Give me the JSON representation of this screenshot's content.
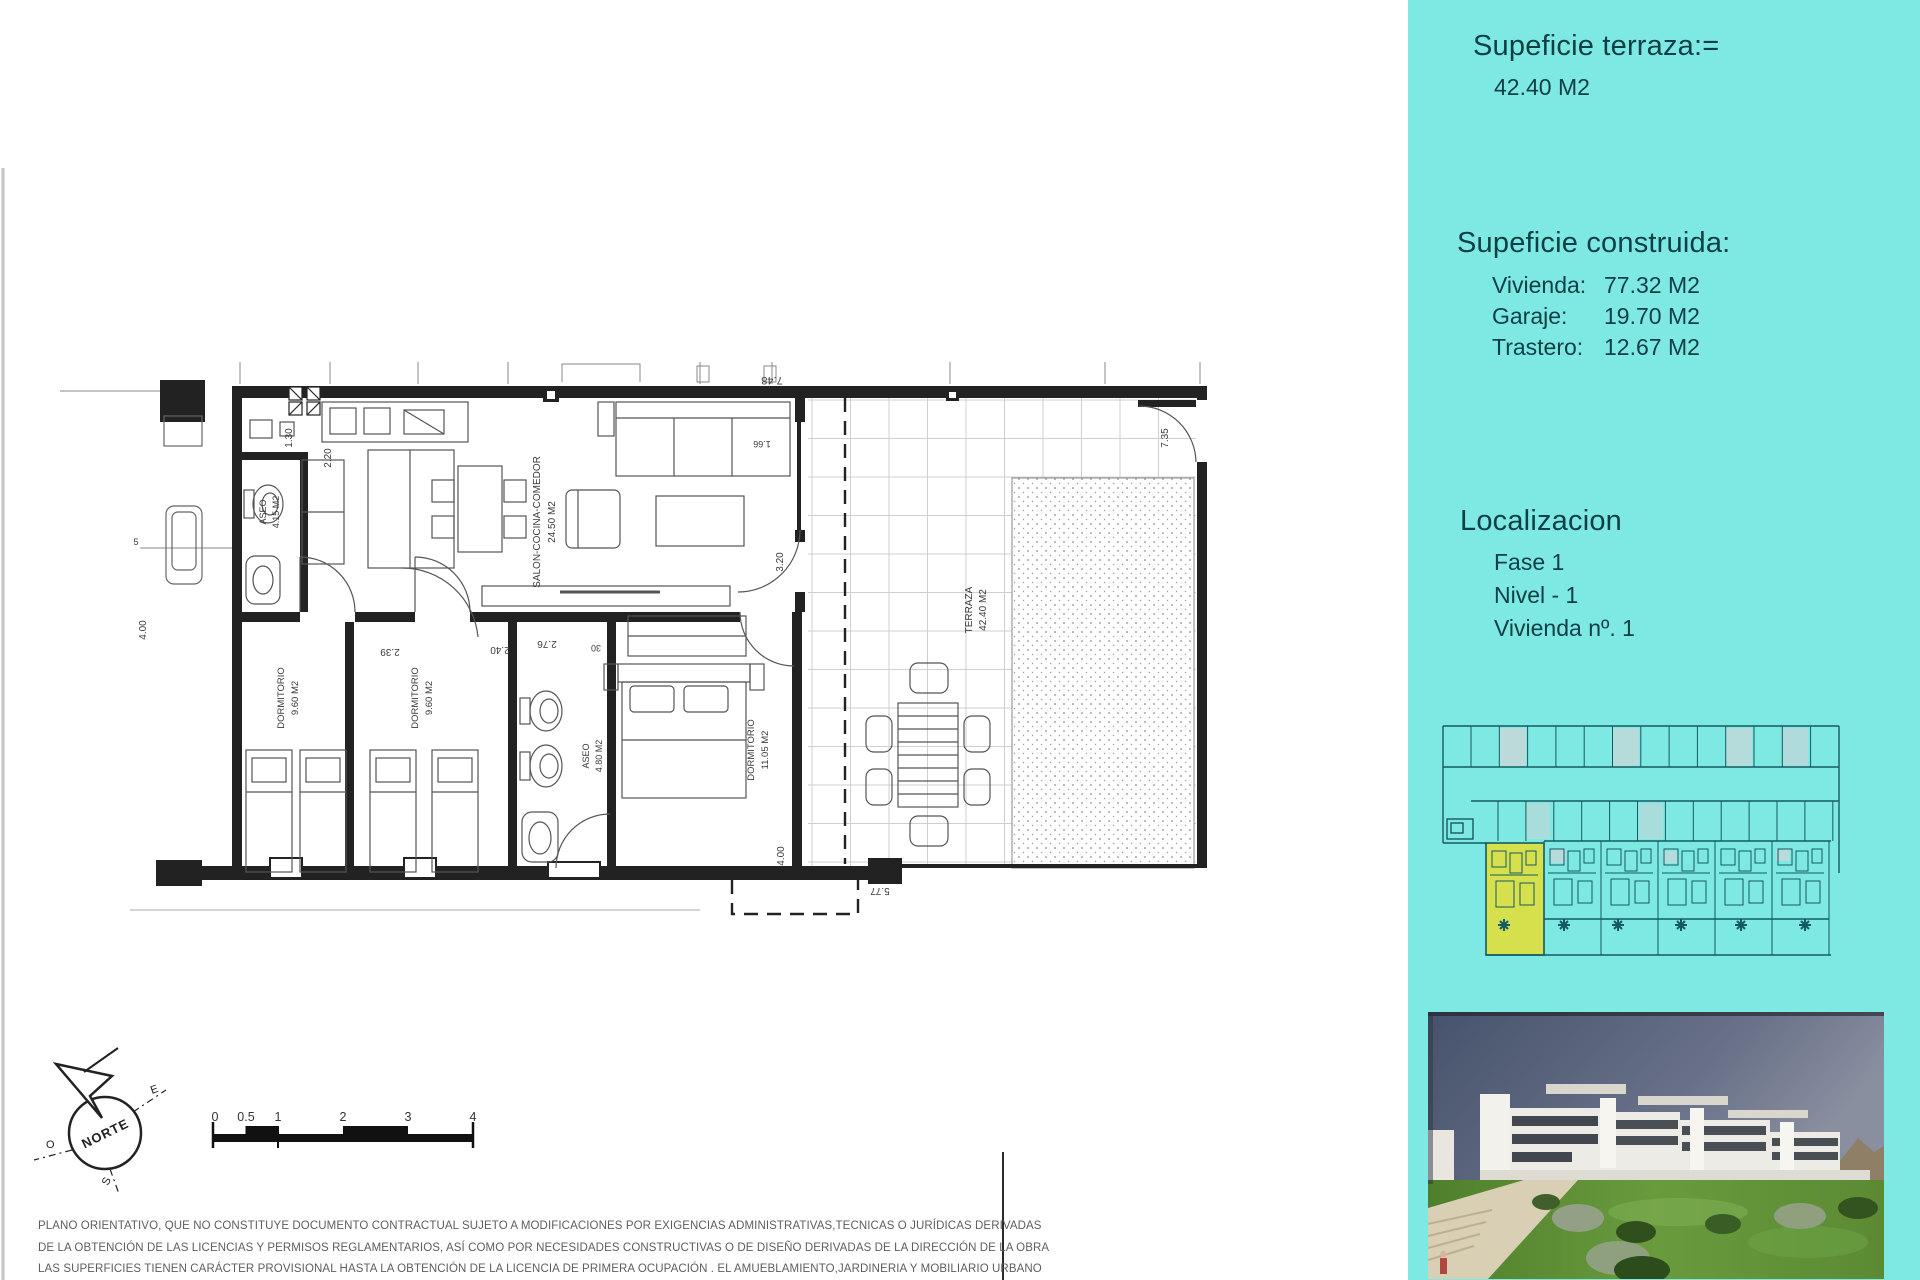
{
  "panel": {
    "terrace_heading": "Supeficie terraza:=",
    "terrace_value": "42.40 M2",
    "built_heading": "Supeficie construida:",
    "built_items": [
      {
        "label": "Vivienda:",
        "value": "77.32 M2"
      },
      {
        "label": "Garaje:",
        "value": "19.70 M2"
      },
      {
        "label": "Trastero:",
        "value": "12.67 M2"
      }
    ],
    "location_heading": "Localizacion",
    "location_items": [
      "Fase 1",
      "Nivel - 1",
      "Vivienda nº. 1"
    ]
  },
  "floor_plan": {
    "room_labels": [
      {
        "t": "ASEO",
        "x": 266,
        "y": 512,
        "r": -90,
        "s": 9
      },
      {
        "t": "4.15 M2",
        "x": 279,
        "y": 512,
        "r": -90,
        "s": 9
      },
      {
        "t": "SALON-COCINA-COMEDOR",
        "x": 540,
        "y": 522,
        "r": -90,
        "s": 10
      },
      {
        "t": "24.50 M2",
        "x": 555,
        "y": 522,
        "r": -90,
        "s": 10
      },
      {
        "t": "TERRAZA",
        "x": 972,
        "y": 610,
        "r": -90,
        "s": 10
      },
      {
        "t": "42.40 M2",
        "x": 986,
        "y": 610,
        "r": -90,
        "s": 10
      },
      {
        "t": "DORMITORIO",
        "x": 284,
        "y": 698,
        "r": -90,
        "s": 9.5
      },
      {
        "t": "9.60 M2",
        "x": 298,
        "y": 698,
        "r": -90,
        "s": 9.5
      },
      {
        "t": "DORMITORIO",
        "x": 418,
        "y": 698,
        "r": -90,
        "s": 9.5
      },
      {
        "t": "9.60 M2",
        "x": 432,
        "y": 698,
        "r": -90,
        "s": 9.5
      },
      {
        "t": "ASEO",
        "x": 589,
        "y": 756,
        "r": -90,
        "s": 9
      },
      {
        "t": "4.80 M2",
        "x": 602,
        "y": 756,
        "r": -90,
        "s": 9
      },
      {
        "t": "DORMITORIO",
        "x": 754,
        "y": 750,
        "r": -90,
        "s": 9.5
      },
      {
        "t": "11.05 M2",
        "x": 768,
        "y": 750,
        "r": -90,
        "s": 9.5
      }
    ],
    "dim_labels": [
      {
        "t": "7.48",
        "x": 772,
        "y": 377,
        "r": 180,
        "s": 11
      },
      {
        "t": "1.66",
        "x": 762,
        "y": 441,
        "r": 180,
        "s": 9
      },
      {
        "t": "1.30",
        "x": 292,
        "y": 438,
        "r": -90,
        "s": 10
      },
      {
        "t": "2.20",
        "x": 331,
        "y": 458,
        "r": -90,
        "s": 10
      },
      {
        "t": "2.39",
        "x": 390,
        "y": 649,
        "r": 180,
        "s": 10
      },
      {
        "t": "2.40",
        "x": 500,
        "y": 647,
        "r": 180,
        "s": 10
      },
      {
        "t": "2.76",
        "x": 547,
        "y": 641,
        "r": 180,
        "s": 10
      },
      {
        "t": "30",
        "x": 596,
        "y": 645,
        "r": 180,
        "s": 9
      },
      {
        "t": "3.20",
        "x": 783,
        "y": 562,
        "r": -90,
        "s": 10
      },
      {
        "t": "4.00",
        "x": 146,
        "y": 630,
        "r": -90,
        "s": 10
      },
      {
        "t": "4.00",
        "x": 784,
        "y": 856,
        "r": -90,
        "s": 10
      },
      {
        "t": "5.77",
        "x": 880,
        "y": 888,
        "r": 180,
        "s": 10
      },
      {
        "t": "7.35",
        "x": 1168,
        "y": 438,
        "r": -90,
        "s": 10
      },
      {
        "t": "5",
        "x": 136,
        "y": 545,
        "r": 0,
        "s": 9
      }
    ]
  },
  "compass": {
    "north_label": "NORTE",
    "east": "E",
    "west": "O",
    "south": "S"
  },
  "scale_bar": {
    "tick_labels": [
      "0",
      "0.5",
      "1",
      "2",
      "3",
      "4"
    ]
  },
  "disclaimer_lines": [
    "PLANO ORIENTATIVO, QUE NO CONSTITUYE DOCUMENTO CONTRACTUAL SUJETO A MODIFICACIONES POR EXIGENCIAS ADMINISTRATIVAS,TECNICAS O JURÍDICAS DERIVADAS",
    "DE LA OBTENCIÓN DE LAS LICENCIAS Y PERMISOS REGLAMENTARIOS, ASÍ COMO POR NECESIDADES CONSTRUCTIVAS  O DE DISEÑO DERIVADAS DE LA DIRECCIÓN DE LA OBRA",
    "LAS SUPERFICIES TIENEN CARÁCTER PROVISIONAL HASTA LA OBTENCIÓN DE LA LICENCIA DE PRIMERA OCUPACIÓN . EL AMUEBLAMIENTO,JARDINERIA Y MOBILIARIO URBANO"
  ],
  "colors": {
    "panel_bg": "#7ee8e3",
    "panel_text": "#0d3f44",
    "site_plan_line": "#145a62",
    "site_plan_highlight": "#d6e04c",
    "plan_line": "#222222"
  }
}
